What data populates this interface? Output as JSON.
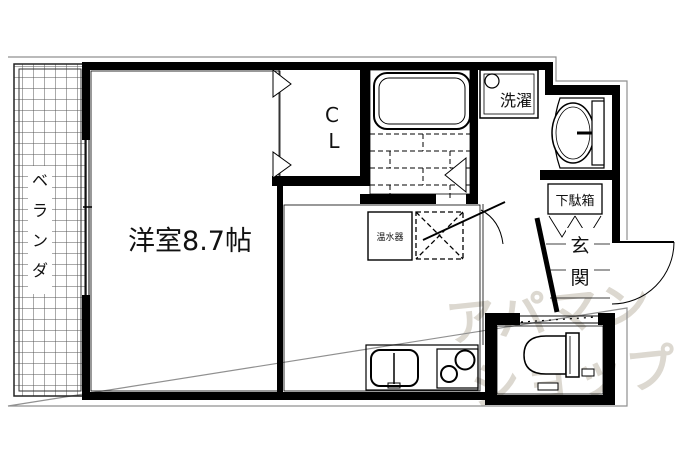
{
  "plan": {
    "title": "apartment-floor-plan",
    "veranda": {
      "label": "ベランダ",
      "label_chars": [
        "ベ",
        "ラ",
        "ン",
        "ダ"
      ]
    },
    "main_room": {
      "label": "洋室8.7帖"
    },
    "closet": {
      "label": "CL",
      "label_chars": [
        "C",
        "L"
      ]
    },
    "laundry": {
      "label": "洗濯"
    },
    "shoe_box": {
      "label": "下駄箱"
    },
    "entrance": {
      "label": "玄関",
      "label_chars": [
        "玄",
        "関"
      ]
    },
    "water_heater": {
      "label": "温水器"
    },
    "watermark": {
      "line1": "アパマン",
      "line2": "ショップ"
    },
    "fixtures": [
      "bathtub",
      "washing-machine-space",
      "washbasin",
      "toilet",
      "kitchen-sink",
      "stove-2-burner",
      "refrigerator-space"
    ],
    "colors": {
      "wall": "#000000",
      "background": "#ffffff",
      "watermark": "#dcd8d0",
      "outline": "#909090"
    }
  }
}
